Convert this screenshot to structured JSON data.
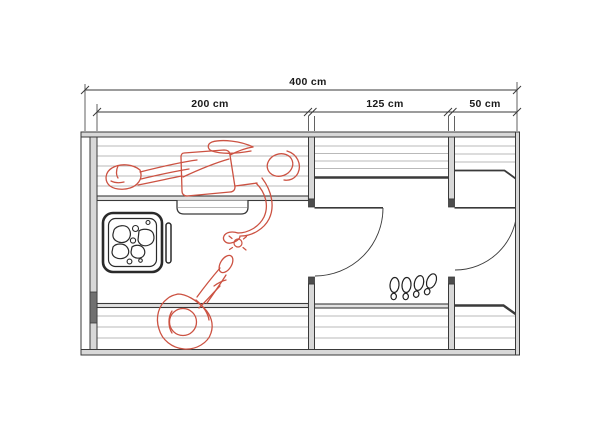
{
  "floor_plan": {
    "unit": "cm",
    "total_width_label": "400 cm",
    "rooms": [
      {
        "name": "sauna-room",
        "width_label": "200 cm"
      },
      {
        "name": "washroom",
        "width_label": "125 cm"
      },
      {
        "name": "entry-room",
        "width_label": "50 cm"
      }
    ]
  },
  "icons": [
    "sauna-heater-icon",
    "heater-rail-icon",
    "steam-splash-icon",
    "footprints-icon",
    "lying-person-figure",
    "sitting-person-figure",
    "door-swing-arc"
  ],
  "colors": {
    "background": "#ffffff",
    "outline": "#3a3a3a",
    "wall_fill": "#d8d8d8",
    "wall_cap": "#4d4d4d",
    "wall_dark_segment": "#707070",
    "bench_slat": "#b9b9b9",
    "bench_edge_fill": "#e2e2e2",
    "figure_red": "#cc5242",
    "footprint_line": "#222222",
    "label_text": "#1a1a1a"
  }
}
